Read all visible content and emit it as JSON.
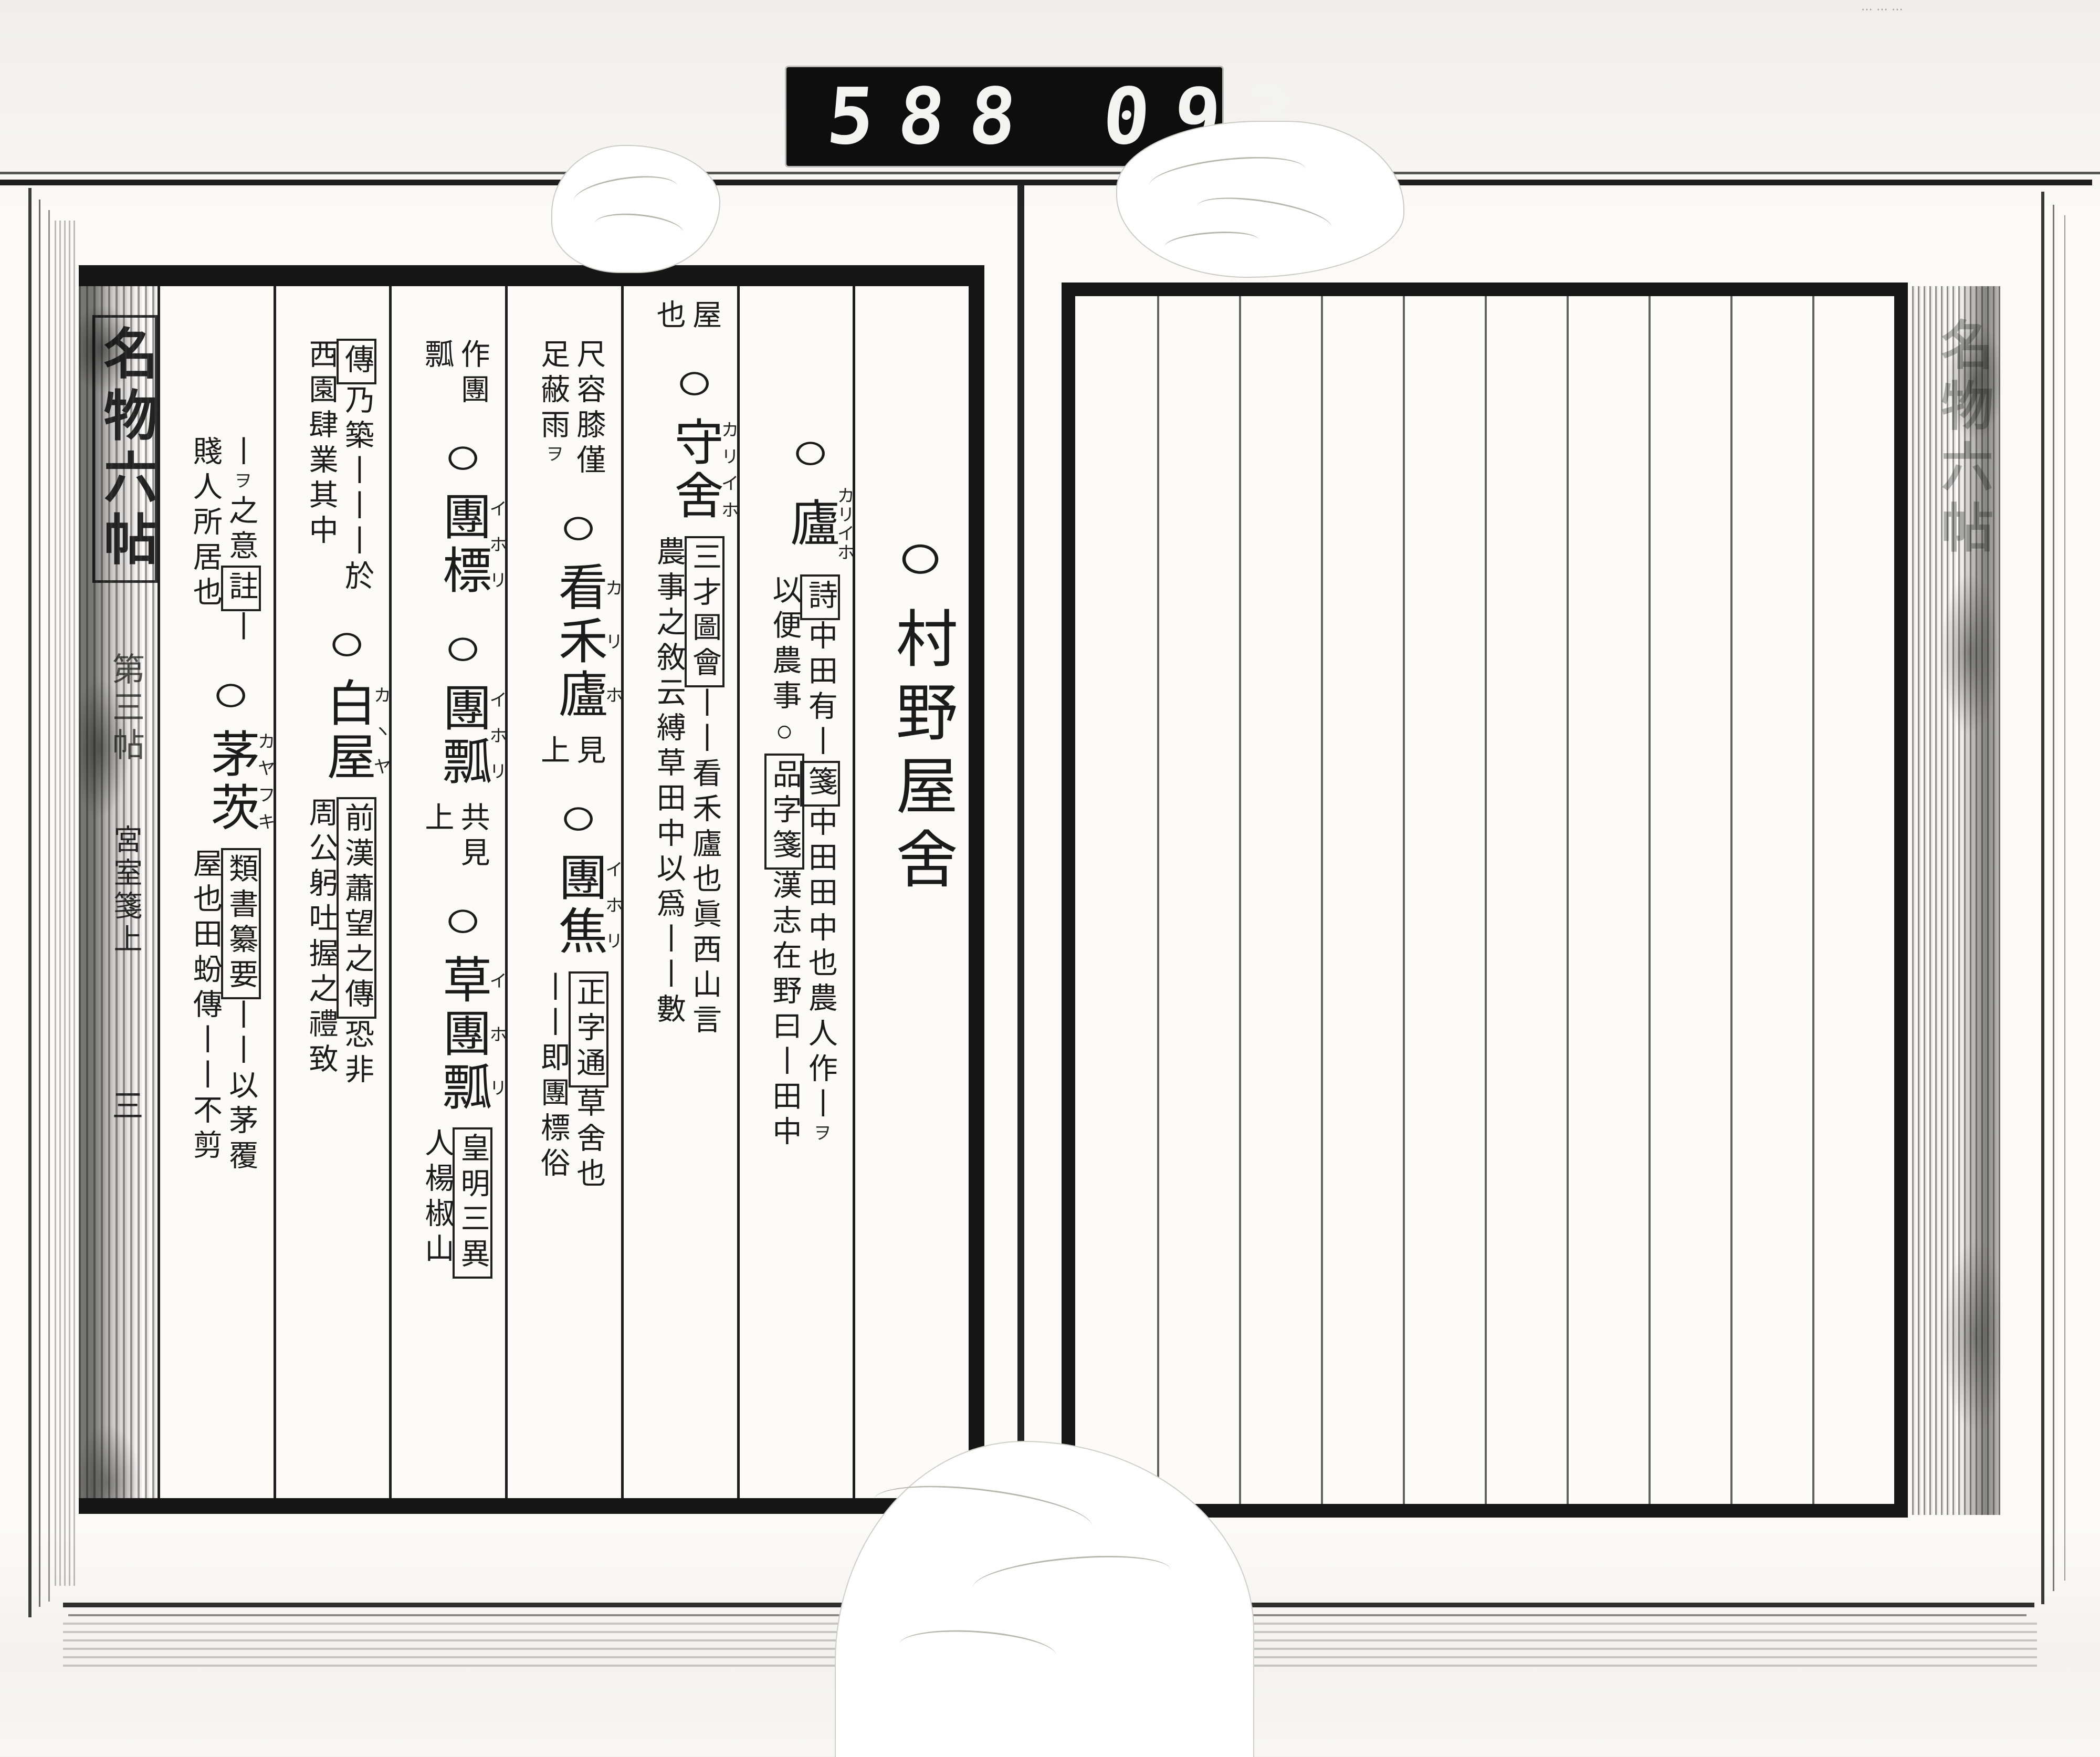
{
  "counter": {
    "left": "588",
    "right": "093",
    "decimal": "."
  },
  "corner_note": "⋯⋯⋯",
  "left_page": {
    "hanshin": {
      "title": "名物六帖",
      "volume": "第三帖",
      "section": "宮室箋上",
      "page_number": "三"
    },
    "columns": [
      {
        "name": "section-header",
        "pad": 420,
        "size": "xl",
        "blocks": [
          {
            "type": "head",
            "circle": true,
            "text": "村野屋舍",
            "furi": ""
          }
        ]
      },
      {
        "name": "entry-ro",
        "pad": 235,
        "blocks": [
          {
            "type": "head",
            "circle": true,
            "text": "廬",
            "furi": "カリイホ"
          },
          {
            "type": "wari",
            "right": "【詩】中田有丨【箋】中田田中也農人作丨ヲ",
            "left": "以便農事○【品字箋】漢志在野曰丨田中"
          }
        ]
      },
      {
        "name": "entry-shusha",
        "pad": 15,
        "blocks": [
          {
            "type": "wari",
            "right": "屋",
            "left": "也"
          },
          {
            "type": "head",
            "circle": true,
            "text": "守舍",
            "furi": "カリイホ"
          },
          {
            "type": "wari",
            "right": "【三才圖會】丨丨看禾廬也眞西山言",
            "left": "農事之敘云縛草田中以爲丨丨數"
          }
        ]
      },
      {
        "name": "entry-kankaro-dansho",
        "pad": 90,
        "blocks": [
          {
            "type": "wari",
            "right": "尺容膝僅",
            "left": "足蔽雨ヲ"
          },
          {
            "type": "head",
            "circle": true,
            "text": "看禾廬",
            "furi": "カリホ"
          },
          {
            "type": "wari",
            "right": "見",
            "left": "上"
          },
          {
            "type": "head",
            "circle": true,
            "text": "團焦",
            "furi": "イホリ"
          },
          {
            "type": "wari",
            "right": "【正字通】草舍也",
            "left": "丨丨即團標俗"
          }
        ]
      },
      {
        "name": "entry-danpyo",
        "pad": 90,
        "blocks": [
          {
            "type": "wari",
            "right": "作團",
            "left": "瓢"
          },
          {
            "type": "head",
            "circle": true,
            "text": "團標",
            "furi": "イホリ"
          },
          {
            "type": "head",
            "circle": true,
            "text": "團瓢",
            "furi": "イホリ"
          },
          {
            "type": "wari",
            "right": "共見",
            "left": "上"
          },
          {
            "type": "head",
            "circle": true,
            "text": "草團瓢",
            "furi": "イホリ"
          },
          {
            "type": "wari",
            "right": "【皇明三異】",
            "left": "人楊椒山"
          }
        ]
      },
      {
        "name": "entry-hakuoku",
        "pad": 90,
        "blocks": [
          {
            "type": "wari",
            "right": "【傳】乃築丨丨丨於",
            "left": "西園肆業其中"
          },
          {
            "type": "head",
            "circle": true,
            "text": "白屋",
            "furi": "カヽヤ"
          },
          {
            "type": "wari",
            "right": "【前漢蕭望之傳】恐非",
            "left": "周公躬吐握之禮致"
          }
        ]
      },
      {
        "name": "entry-boushi",
        "pad": 275,
        "blocks": [
          {
            "type": "wari",
            "right": "丨ヲ之意【註】丨",
            "left": "賤人所居也"
          },
          {
            "type": "head",
            "circle": true,
            "text": "茅茨",
            "furi": "カヤフキ"
          },
          {
            "type": "wari",
            "right": "【類書纂要】丨丨以茅覆",
            "left": "屋也田蚡傳丨丨不剪"
          }
        ]
      }
    ]
  },
  "right_page": {
    "column_count": 10,
    "hanshin_title": "名物六帖"
  }
}
